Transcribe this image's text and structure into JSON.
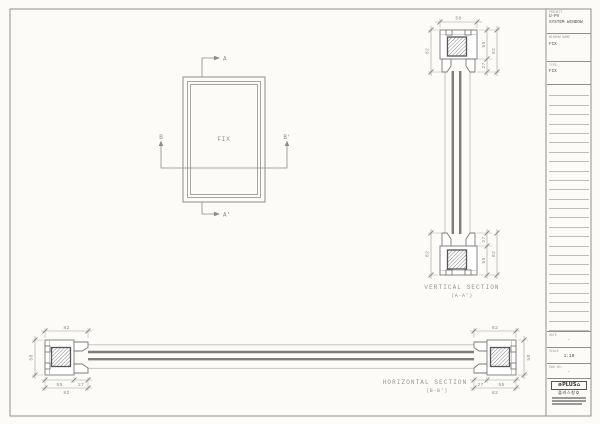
{
  "sheet": {
    "bg": "#fcfbf8",
    "border_color": "#8f8f8f",
    "line_color": "#7a7a7a",
    "dim_color": "#8a8a8a"
  },
  "plan_view": {
    "label": "FIX",
    "section_a_top": "A",
    "section_a_bottom": "A'",
    "section_b_left": "B",
    "section_b_right": "B'"
  },
  "vertical_section": {
    "caption": "VERTICAL SECTION",
    "caption_sub": "(A-A')",
    "dim_top_width": "58",
    "dim_top_left": "82",
    "dim_top_inner_upper": "55",
    "dim_top_inner_lower": "27",
    "dim_top_outer": "82",
    "dim_bottom_left": "82",
    "dim_bottom_inner_upper": "27",
    "dim_bottom_inner_lower": "55",
    "dim_bottom_outer": "82"
  },
  "horizontal_section": {
    "caption": "HORIZONTAL SECTION",
    "caption_sub": "(B-B')",
    "left": {
      "top": "82",
      "side": "58",
      "inner_a": "55",
      "inner_b": "27",
      "outer": "82"
    },
    "right": {
      "top": "82",
      "side": "58",
      "inner_a": "27",
      "inner_b": "55",
      "outer": "82"
    }
  },
  "titleblock": {
    "project": {
      "label": "PROJECT",
      "line1": "U-PV",
      "line2": "SYSTEM WINDOW"
    },
    "window_name": {
      "label": "WINDOW NAME",
      "value": "FIX"
    },
    "type": {
      "label": "TYPE",
      "value": "FIX"
    },
    "ruled_line_count": 26,
    "date": {
      "label": "DATE",
      "value": "-"
    },
    "scale": {
      "label": "SCALE",
      "value": "1:10"
    },
    "dwg_no": {
      "label": "DWG NO.",
      "value": "-"
    },
    "logo": {
      "brand": "PLUS",
      "korean": "플러스창호"
    }
  }
}
